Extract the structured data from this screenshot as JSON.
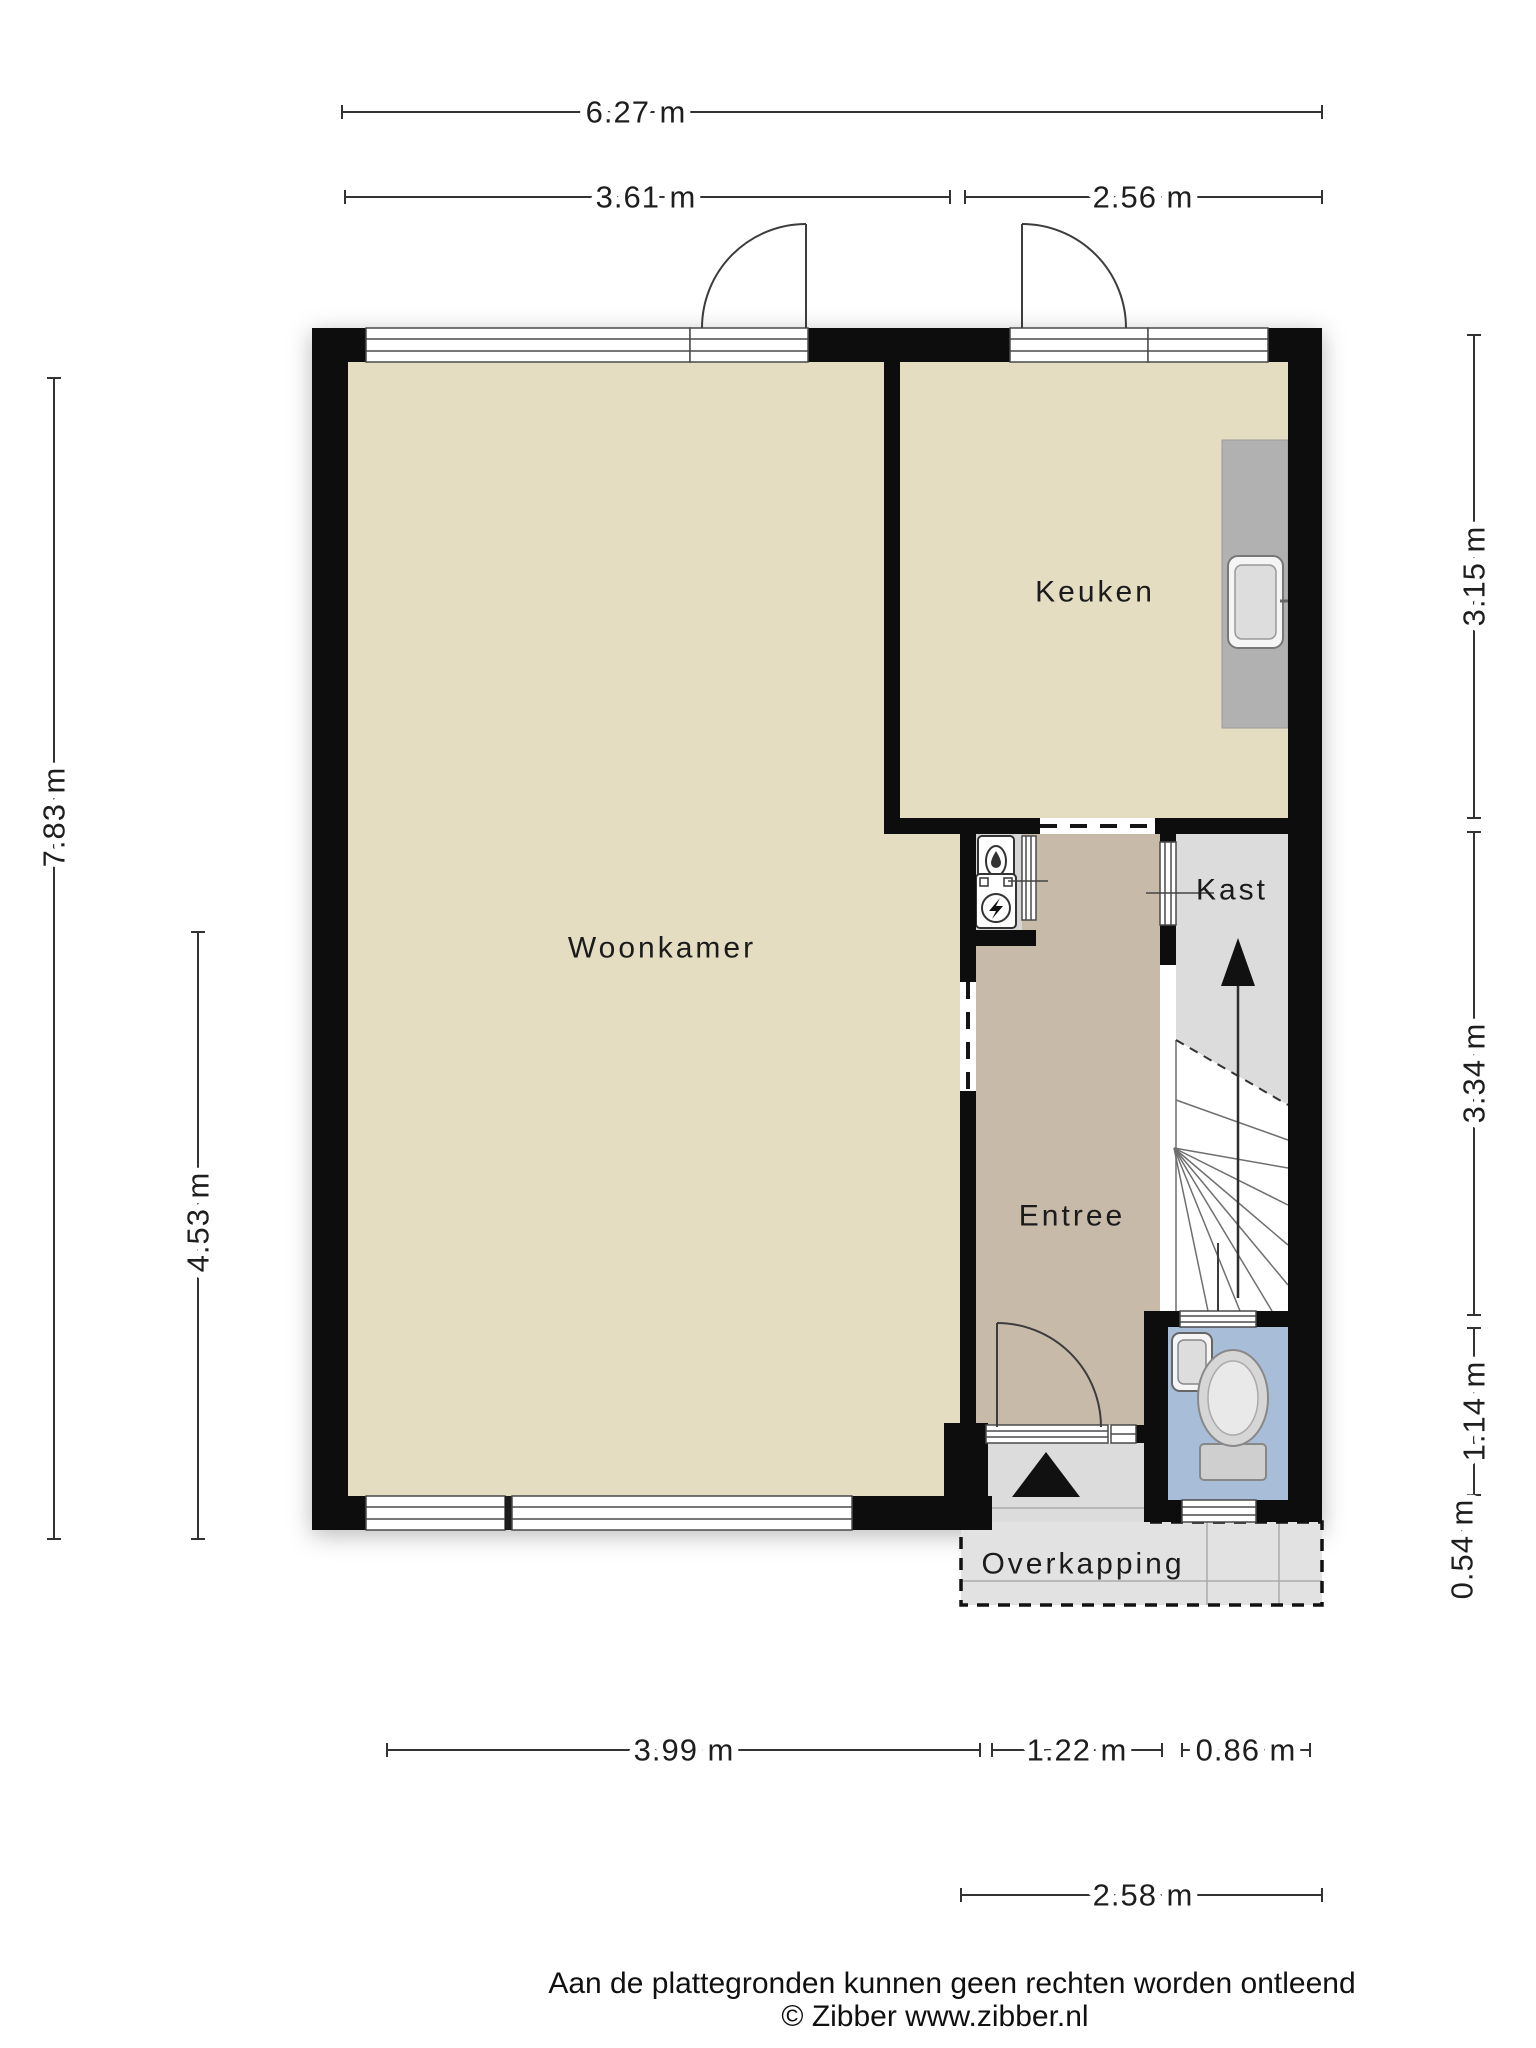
{
  "plan": {
    "rooms": {
      "woonkamer": {
        "label": "Woonkamer"
      },
      "keuken": {
        "label": "Keuken"
      },
      "kast": {
        "label": "Kast"
      },
      "entree": {
        "label": "Entree"
      },
      "overkapping": {
        "label": "Overkapping"
      }
    },
    "dimensions": {
      "total_width": {
        "label": "6.27 m"
      },
      "woonkamer_width": {
        "label": "3.61 m"
      },
      "keuken_width": {
        "label": "2.56 m"
      },
      "total_height": {
        "label": "7.83 m"
      },
      "woonkamer_lower_height": {
        "label": "4.53 m"
      },
      "keuken_height": {
        "label": "3.15 m"
      },
      "hal_height": {
        "label": "3.34 m"
      },
      "toilet_height": {
        "label": "1.14 m"
      },
      "rear_offset": {
        "label": "0.54 m"
      },
      "woonkamer_inner_width": {
        "label": "3.99 m"
      },
      "entree_width": {
        "label": "1.22 m"
      },
      "toilet_width": {
        "label": "0.86 m"
      },
      "overkapping_width": {
        "label": "2.58 m"
      }
    },
    "colors": {
      "wall": "#0d0d0d",
      "floor_living": "#e4ddc2",
      "floor_hall": "#c8baa9",
      "floor_toilet": "#a8bdd8",
      "floor_closet": "#dcdcdc",
      "floor_niche": "#d6d6d6",
      "floor_outdoor": "#e2e2e2",
      "floor_porch": "#dcdcdc",
      "counter": "#b1b1b1"
    },
    "icons": [
      "sink-icon",
      "faucet-icon",
      "toilet-icon",
      "handbasin-icon",
      "water-meter-icon",
      "electric-meter-icon",
      "stairs-up-arrow-icon",
      "entrance-arrow-icon"
    ]
  },
  "footer": {
    "disclaimer": "Aan de plattegronden kunnen geen rechten worden ontleend",
    "credit": "© Zibber www.zibber.nl"
  }
}
